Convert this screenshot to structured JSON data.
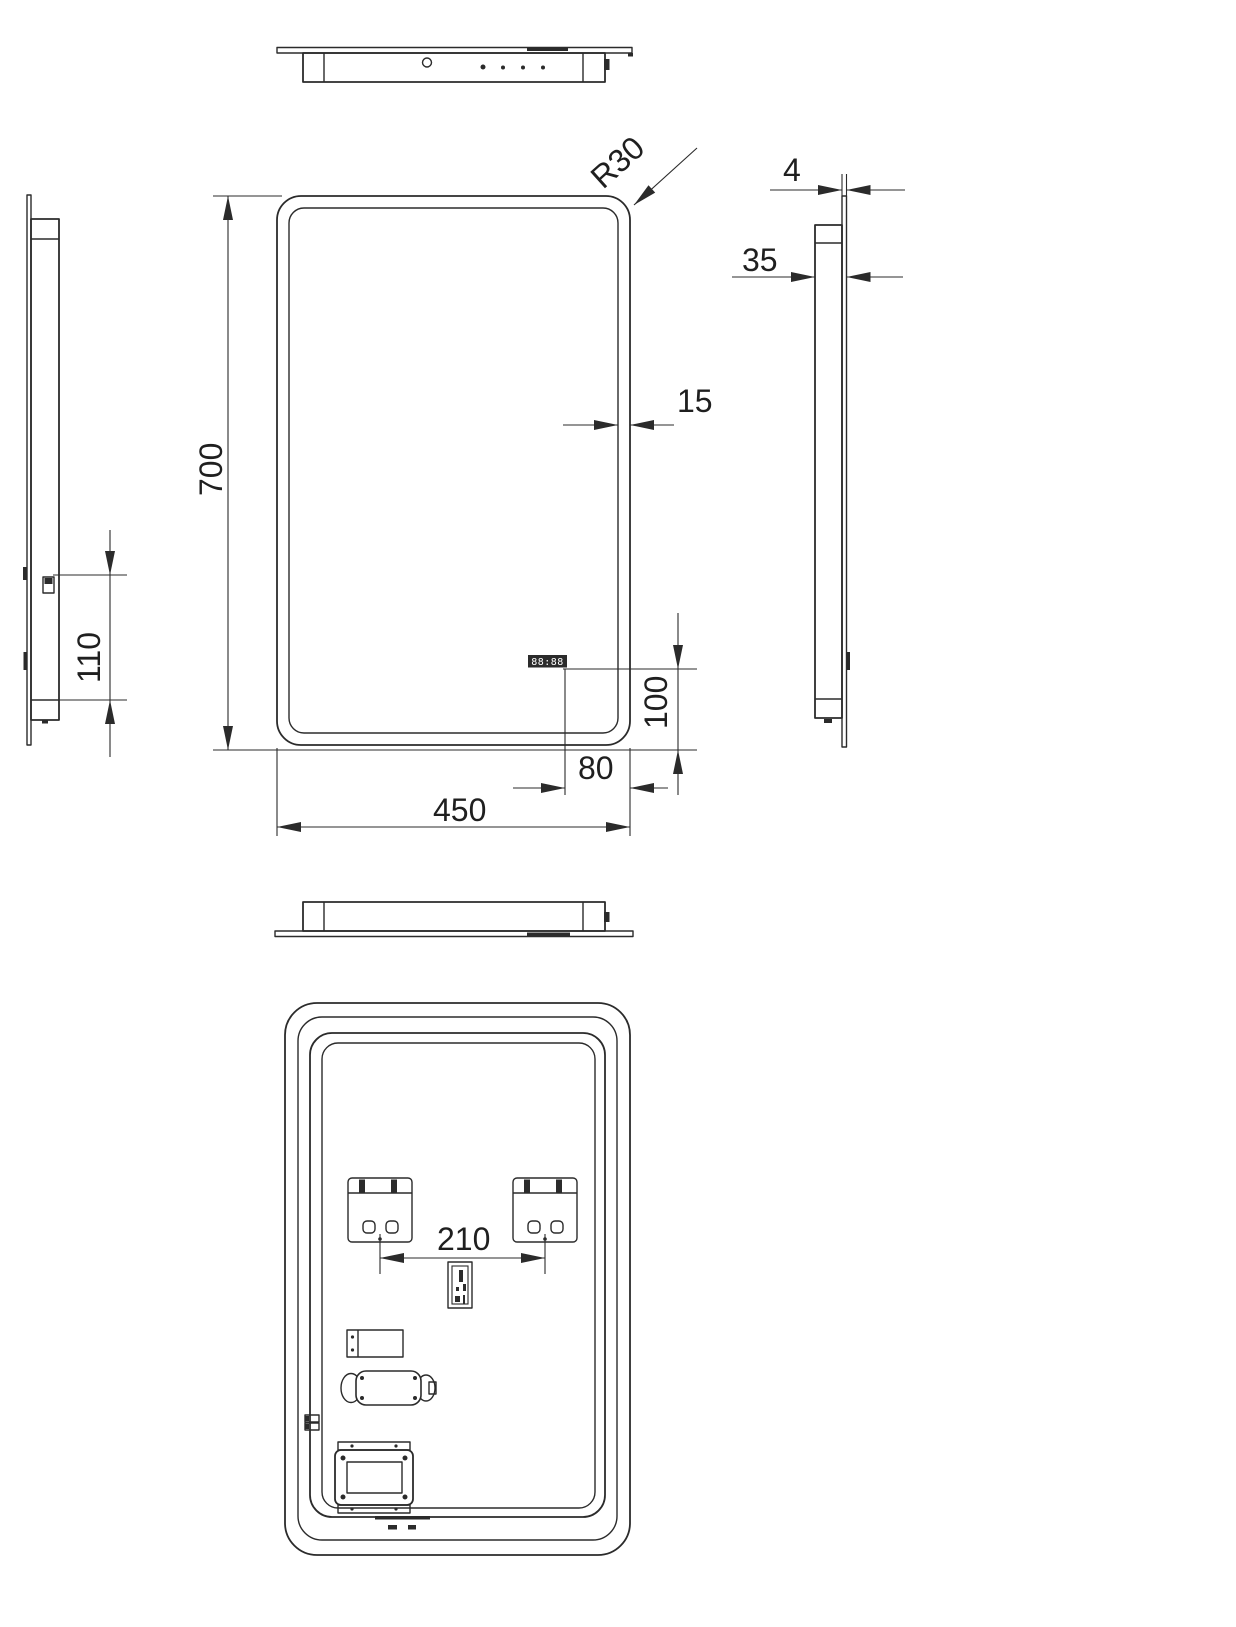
{
  "drawing": {
    "title": "Mirror multi-view dimension drawing",
    "dimensions": {
      "height": "700",
      "width": "450",
      "corner_radius": "R30",
      "bezel": "15",
      "display_from_right": "80",
      "display_from_bottom": "100",
      "switch_from_bottom": "110",
      "glass_thickness": "4",
      "depth": "35",
      "bracket_spacing": "210"
    },
    "display": {
      "clock": "88:88"
    },
    "colors": {
      "line": "#2b2b2b",
      "text": "#1f1f1f",
      "background": "#ffffff"
    }
  }
}
